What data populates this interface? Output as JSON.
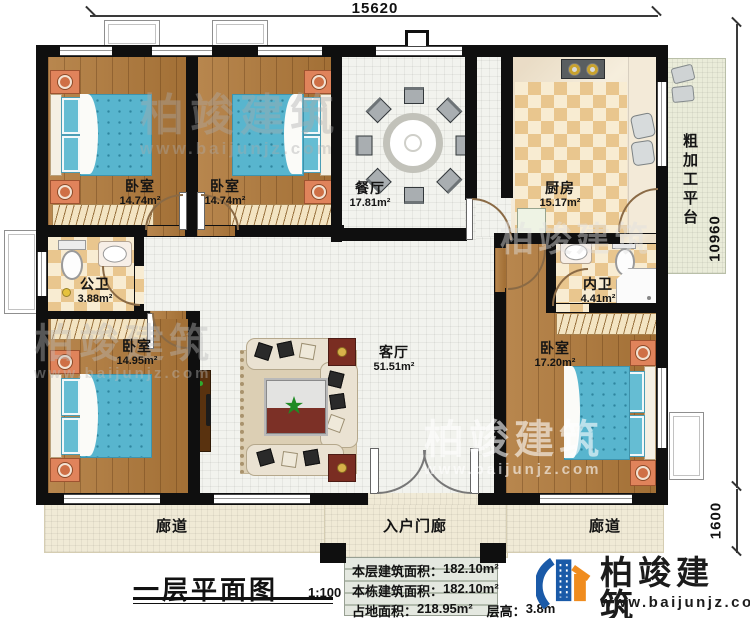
{
  "dimensions": {
    "top": "15620",
    "right_upper": "10960",
    "right_lower": "1600"
  },
  "rooms": {
    "bedroom_tl": {
      "name": "卧室",
      "area": "14.74m²"
    },
    "bedroom_tm": {
      "name": "卧室",
      "area": "14.74m²"
    },
    "dining": {
      "name": "餐厅",
      "area": "17.81m²"
    },
    "kitchen": {
      "name": "厨房",
      "area": "15.17m²"
    },
    "platform": {
      "name": "粗加工平台"
    },
    "public_bath": {
      "name": "公卫",
      "area": "3.88m²"
    },
    "inner_bath": {
      "name": "内卫",
      "area": "4.41m²"
    },
    "living": {
      "name": "客厅",
      "area": "51.51m²"
    },
    "bedroom_bl": {
      "name": "卧室",
      "area": "14.95m²"
    },
    "bedroom_br": {
      "name": "卧室",
      "area": "17.20m²"
    },
    "corridor_left": {
      "name": "廊道"
    },
    "entrance_porch": {
      "name": "入户门廊"
    },
    "corridor_right": {
      "name": "廊道"
    }
  },
  "title_block": {
    "plan_name": "一层平面图",
    "scale": "1:100",
    "stats": [
      {
        "label": "本层建筑面积：",
        "value": "182.10m²"
      },
      {
        "label": "本栋建筑面积：",
        "value": "182.10m²"
      },
      {
        "label": "占地面积：",
        "value": "218.95m²"
      },
      {
        "label": "层高：",
        "value": "3.8m"
      }
    ]
  },
  "brand": {
    "name": "柏竣建筑",
    "website": "www.baijunjz.com"
  },
  "watermark": {
    "text": "柏竣建筑",
    "website": "www.baijunjz.com"
  },
  "colors": {
    "wall": "#0f0f0f",
    "wood_floor": "#b0793a",
    "tile_floor": "#f2f3ee",
    "checker_tile": "#e9c68e",
    "bed_fabric": "#58b5ce",
    "corridor_floor": "#f0ead6",
    "brand_blue": "#1a5aa8",
    "brand_orange": "#f08c1e"
  }
}
